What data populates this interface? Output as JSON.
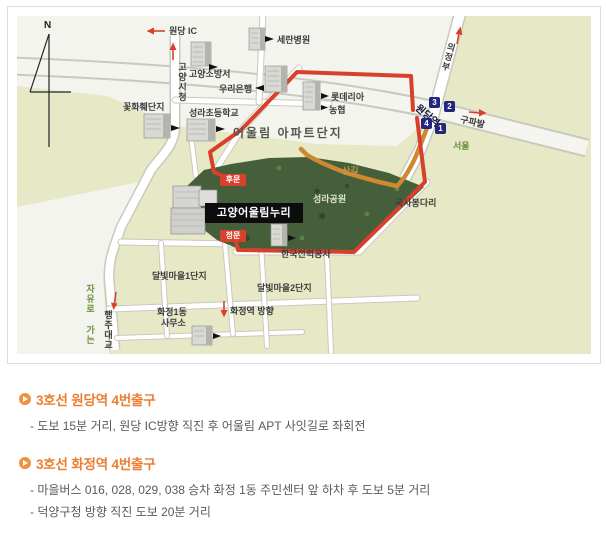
{
  "map": {
    "compass": "N",
    "labels": {
      "wondang_ic": "원당 IC",
      "goyang_city_hall": "고양시청",
      "fire_station": "고양소방서",
      "seran_hospital": "세란병원",
      "woori_bank": "우리은행",
      "lotteria": "롯데리아",
      "nonghyup": "농협",
      "flower_complex": "꽃화훼단지",
      "seongna_elementary": "성라초등학교",
      "oullim_apt": "어울림 아파트단지",
      "uijeongbu": "의정부",
      "wondang_station": "원당역",
      "gupabal": "구파발",
      "seoul": "서울",
      "trail": "산길",
      "seongna_park": "성라공원",
      "guksabong_bridge": "국사봉다리",
      "arena": "고양어울림누리",
      "back_gate": "후문",
      "main_gate": "정문",
      "kepco": "한국전력공사",
      "dalbit_village1": "달빛마을1단지",
      "dalbit_village2": "달빛마을2단지",
      "hwajeong_office_1": "화정1동",
      "hwajeong_office_2": "사무소",
      "hwajeong_direction": "화정역 방향",
      "jayuro_road": "자유로 가는 길",
      "haengju_bridge": "행주대교"
    },
    "exits": [
      "3",
      "2",
      "4",
      "1"
    ],
    "colors": {
      "map_beige": "#e7e8c6",
      "park_green": "#455f3b",
      "route_red": "#d8402c",
      "trail_orange": "#ce8a2f",
      "subway_navy": "#23267e",
      "road_text_green": "#6b8f3c",
      "accent_orange": "#ed7d31"
    }
  },
  "directions": [
    {
      "title": "3호선 원당역 4번출구",
      "lines": [
        "- 도보 15분 거리, 원당 IC방향 직진 후 어울림 APT 사잇길로 좌회전"
      ]
    },
    {
      "title": "3호선 화정역 4번출구",
      "lines": [
        "- 마을버스 016, 028, 029, 038 승차 화정 1동 주민센터 앞 하차 후 도보 5분 거리",
        "- 덕양구청 방향 직진 도보 20분 거리"
      ]
    }
  ]
}
